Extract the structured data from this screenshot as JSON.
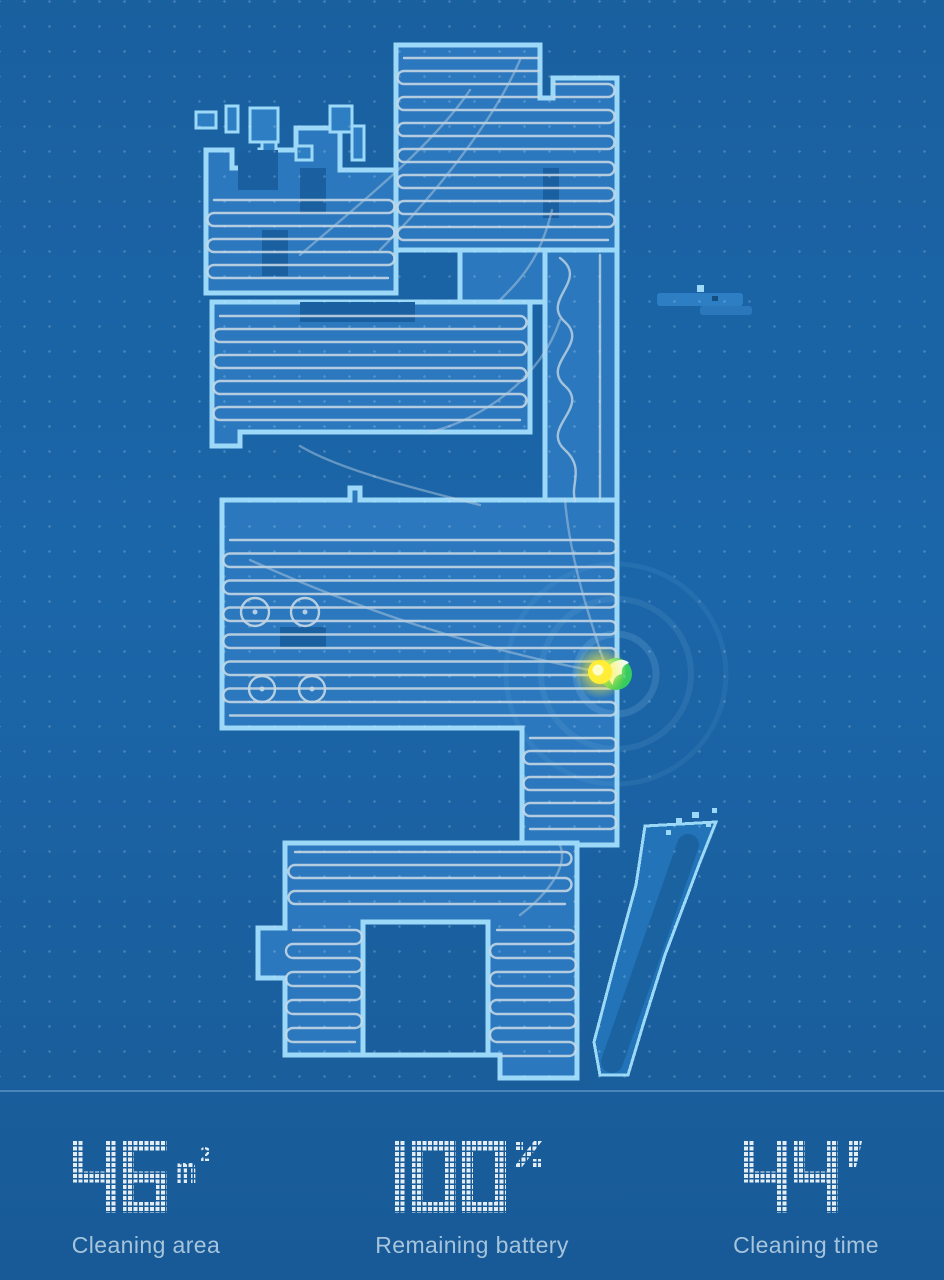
{
  "screen": {
    "name": "Robot vacuum cleaning map"
  },
  "map": {
    "type": "vacuum-blueprint-map",
    "robot_marker": {
      "x": 616,
      "y": 674,
      "color": "#3fd267"
    },
    "charger_marker": {
      "x": 600,
      "y": 672,
      "color": "#ffee35"
    },
    "colors": {
      "background": "#1a62a3",
      "cleaned_area": "#2b78be",
      "wall": "#9cd8f8",
      "path": "#c6d8e5",
      "streak_fill": "#2273b7",
      "streak_core": "#1a5f9e",
      "notch": "#1a5f9f",
      "digit_dots": "#e4edf4"
    }
  },
  "stats": [
    {
      "id": "cleaning-area",
      "value": "46",
      "unit": "m2",
      "unit_display": "m²",
      "label": "Cleaning area"
    },
    {
      "id": "remaining-battery",
      "value": "100",
      "unit": "percent",
      "unit_display": "%",
      "label": "Remaining battery"
    },
    {
      "id": "cleaning-time",
      "value": "44",
      "unit": "minutes",
      "unit_display": "'",
      "label": "Cleaning time"
    }
  ]
}
